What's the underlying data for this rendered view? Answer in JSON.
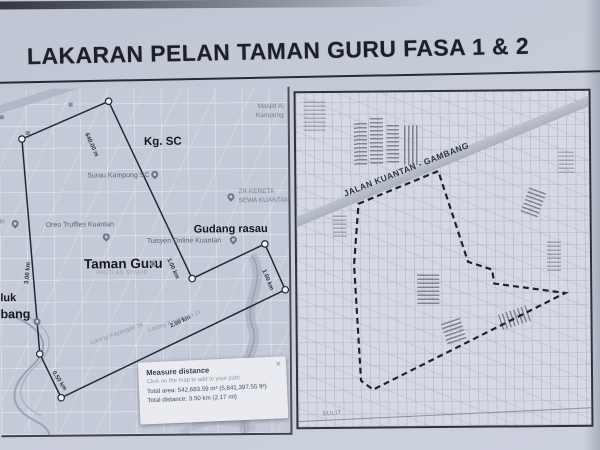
{
  "page_title": "LAKARAN PELAN TAMAN GURU FASA 1 & 2",
  "left_map": {
    "places": {
      "kg_sc": "Kg. SC",
      "masjid_line1": "Masjid Al",
      "masjid_line2": "Kampung",
      "surau_kampung": "Surau Kampung SC",
      "zr_kereta_line1": "ZR KERETA",
      "zr_kereta_line2": "SEWA KUANTAN",
      "oreo_truffles": "Oreo Truffles Kuantan",
      "gudang_rasau": "Gudang rasau",
      "tuisyen_online": "Tuisyen Online Kuantan",
      "taman_guru": "Taman Guru",
      "pasti_as_syafie": "PASTI AS SYAFIE",
      "edge_fragment_in": "in",
      "edge_fragment_luk": "luk",
      "edge_fragment_bang": "bang",
      "street_1": "Lorong Kayangan 36",
      "street_2": "Lorong Kayangan 31"
    },
    "measurements": {
      "seg_640m": "640.00 m",
      "seg_1km": "1.00 km",
      "seg_1_6km": "1.60 km",
      "seg_2km": "2.00 km",
      "seg_0_5km": "0.50 km",
      "seg_3km": "3.00 km"
    },
    "measure_popup": {
      "title": "Measure distance",
      "subtitle": "Click on the map to add to your path",
      "total_area": "Total area: 542,683.59 m² (5,841,397.55 ft²)",
      "total_distance": "Total distance: 3.50 km (2.17 mi)",
      "close_glyph": "×"
    }
  },
  "right_map": {
    "road_label": "JALAN KUANTAN - GAMBANG",
    "corner_text": "SULIT"
  },
  "colors": {
    "paper": "#c7ccd9",
    "ink": "#1d2027",
    "left_map_bg": "#c5cad8",
    "right_map_bg": "#d6d9e3",
    "road_band": "#b2b8c7",
    "popup_bg": "#e9ebf1"
  }
}
